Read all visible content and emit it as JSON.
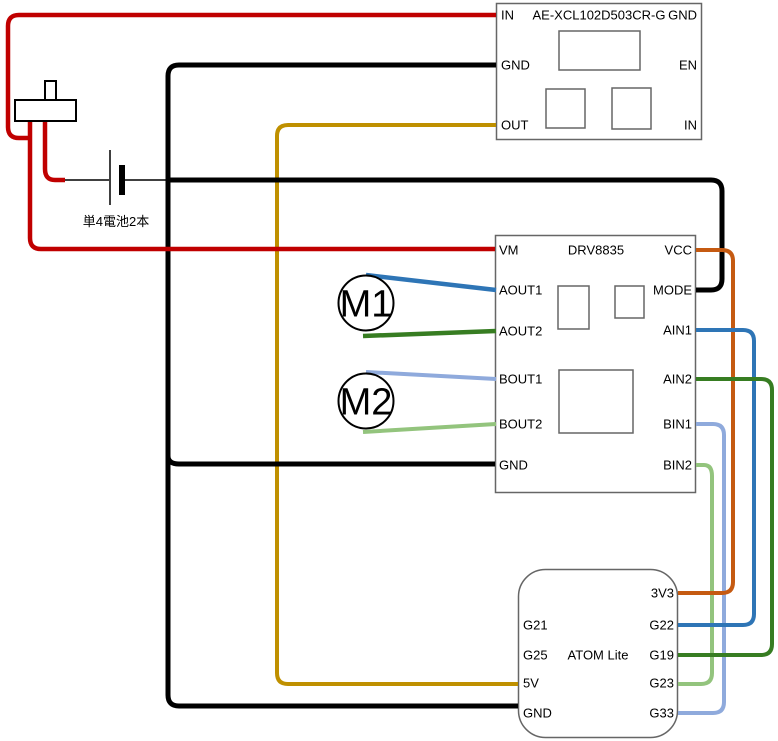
{
  "page": {
    "background": "#ffffff"
  },
  "components": {
    "regulator": {
      "title": "AE-XCL102D503CR-G",
      "pins_left": [
        "IN",
        "GND",
        "OUT"
      ],
      "pins_right": [
        "GND",
        "EN",
        "IN"
      ]
    },
    "driver": {
      "title": "DRV8835",
      "pins_left": [
        "VM",
        "AOUT1",
        "AOUT2",
        "BOUT1",
        "BOUT2",
        "GND"
      ],
      "pins_right": [
        "VCC",
        "MODE",
        "AIN1",
        "AIN2",
        "BIN1",
        "BIN2"
      ]
    },
    "mcu": {
      "title": "ATOM Lite",
      "pins_left": [
        "G21",
        "G25",
        "5V",
        "GND"
      ],
      "pins_right": [
        "3V3",
        "G22",
        "G19",
        "G23",
        "G33"
      ]
    },
    "battery": {
      "label": "単4電池2本"
    },
    "motor1": {
      "label": "M1"
    },
    "motor2": {
      "label": "M2"
    }
  },
  "colors": {
    "red": "#C00000",
    "black": "#000000",
    "yellow": "#BF9000",
    "orange": "#C55A11",
    "blue": "#2E75B6",
    "green": "#377D22",
    "light_blue": "#8FAADC",
    "light_green": "#93C47D",
    "box_border": "#666666"
  },
  "wires": [
    {
      "name": "wire-battery-positive-lead",
      "from": "battery-plus",
      "to": "switch-wire",
      "color": "#000000",
      "width": 1.5,
      "points": [
        [
          65,
          180
        ],
        [
          109,
          180
        ]
      ]
    },
    {
      "name": "wire-battery-negative-lead",
      "from": "battery-minus",
      "to": "gnd-junction",
      "color": "#000000",
      "width": 1.5,
      "points": [
        [
          125,
          180
        ],
        [
          167,
          180
        ]
      ]
    },
    {
      "name": "wire-regulator-out-to-5v",
      "from": "regulator.OUT",
      "to": "mcu.5V",
      "color": "#BF9000",
      "width": 4,
      "points": [
        [
          496,
          125
        ],
        [
          277,
          125
        ],
        [
          277,
          684
        ],
        [
          518,
          684
        ]
      ]
    },
    {
      "name": "wire-gnd-bus",
      "from": "regulator.GND",
      "to": "mcu.GND",
      "color": "#000000",
      "width": 5,
      "points": [
        [
          496,
          65
        ],
        [
          168,
          65
        ],
        [
          168,
          706
        ],
        [
          518,
          706
        ]
      ]
    },
    {
      "name": "wire-gnd-branch-driver",
      "from": "gnd-bus",
      "to": "driver.GND",
      "color": "#000000",
      "width": 5,
      "points": [
        [
          168,
          448
        ],
        [
          168,
          464
        ],
        [
          495,
          464
        ]
      ]
    },
    {
      "name": "wire-driver-mode-to-gnd",
      "from": "driver.MODE",
      "to": "gnd-bus",
      "color": "#000000",
      "width": 5,
      "points": [
        [
          696,
          290
        ],
        [
          722,
          290
        ],
        [
          722,
          180
        ],
        [
          168,
          180
        ]
      ]
    },
    {
      "name": "wire-switch-to-battery",
      "from": "switch",
      "to": "battery-plus",
      "color": "#C00000",
      "width": 4.5,
      "points": [
        [
          45,
          121
        ],
        [
          45,
          180
        ],
        [
          65,
          180
        ]
      ]
    },
    {
      "name": "wire-switch-to-regulator-in",
      "from": "switch",
      "to": "regulator.IN",
      "color": "#C00000",
      "width": 4.5,
      "points": [
        [
          30,
          138
        ],
        [
          8,
          138
        ],
        [
          8,
          15
        ],
        [
          496,
          15
        ]
      ]
    },
    {
      "name": "wire-switch-to-driver-vm",
      "from": "switch",
      "to": "driver.VM",
      "color": "#C00000",
      "width": 4.5,
      "points": [
        [
          30,
          121
        ],
        [
          30,
          249
        ],
        [
          495,
          249
        ]
      ]
    },
    {
      "name": "wire-bin2-to-g23",
      "from": "driver.BIN2",
      "to": "mcu.G23",
      "color": "#93C47D",
      "width": 4,
      "points": [
        [
          696,
          465
        ],
        [
          712,
          465
        ],
        [
          712,
          684
        ],
        [
          678,
          684
        ]
      ]
    },
    {
      "name": "wire-bin1-to-g33",
      "from": "driver.BIN1",
      "to": "mcu.G33",
      "color": "#8FAADC",
      "width": 4,
      "points": [
        [
          696,
          424
        ],
        [
          724,
          424
        ],
        [
          724,
          713
        ],
        [
          678,
          713
        ]
      ]
    },
    {
      "name": "wire-vcc-to-3v3",
      "from": "driver.VCC",
      "to": "mcu.3V3",
      "color": "#C55A11",
      "width": 4,
      "points": [
        [
          696,
          250
        ],
        [
          733,
          250
        ],
        [
          733,
          593
        ],
        [
          678,
          593
        ]
      ]
    },
    {
      "name": "wire-ain1-to-g22",
      "from": "driver.AIN1",
      "to": "mcu.G22",
      "color": "#2E75B6",
      "width": 4,
      "points": [
        [
          696,
          330
        ],
        [
          754,
          330
        ],
        [
          754,
          625
        ],
        [
          678,
          625
        ]
      ]
    },
    {
      "name": "wire-ain2-to-g19",
      "from": "driver.AIN2",
      "to": "mcu.G19",
      "color": "#377D22",
      "width": 4,
      "points": [
        [
          696,
          379
        ],
        [
          772,
          379
        ],
        [
          772,
          655
        ],
        [
          678,
          655
        ]
      ]
    },
    {
      "name": "wire-m1-to-aout1",
      "from": "motor1",
      "to": "driver.AOUT1",
      "color": "#2E75B6",
      "width": 4.5,
      "points": [
        [
          366,
          275
        ],
        [
          496,
          290
        ]
      ]
    },
    {
      "name": "wire-m1-to-aout2",
      "from": "motor1",
      "to": "driver.AOUT2",
      "color": "#377D22",
      "width": 4.5,
      "points": [
        [
          363,
          336
        ],
        [
          496,
          331
        ]
      ]
    },
    {
      "name": "wire-m2-to-bout1",
      "from": "motor2",
      "to": "driver.BOUT1",
      "color": "#8FAADC",
      "width": 4,
      "points": [
        [
          366,
          372
        ],
        [
          496,
          379
        ]
      ]
    },
    {
      "name": "wire-m2-to-bout2",
      "from": "motor2",
      "to": "driver.BOUT2",
      "color": "#93C47D",
      "width": 4,
      "points": [
        [
          363,
          432
        ],
        [
          496,
          424
        ]
      ]
    }
  ]
}
